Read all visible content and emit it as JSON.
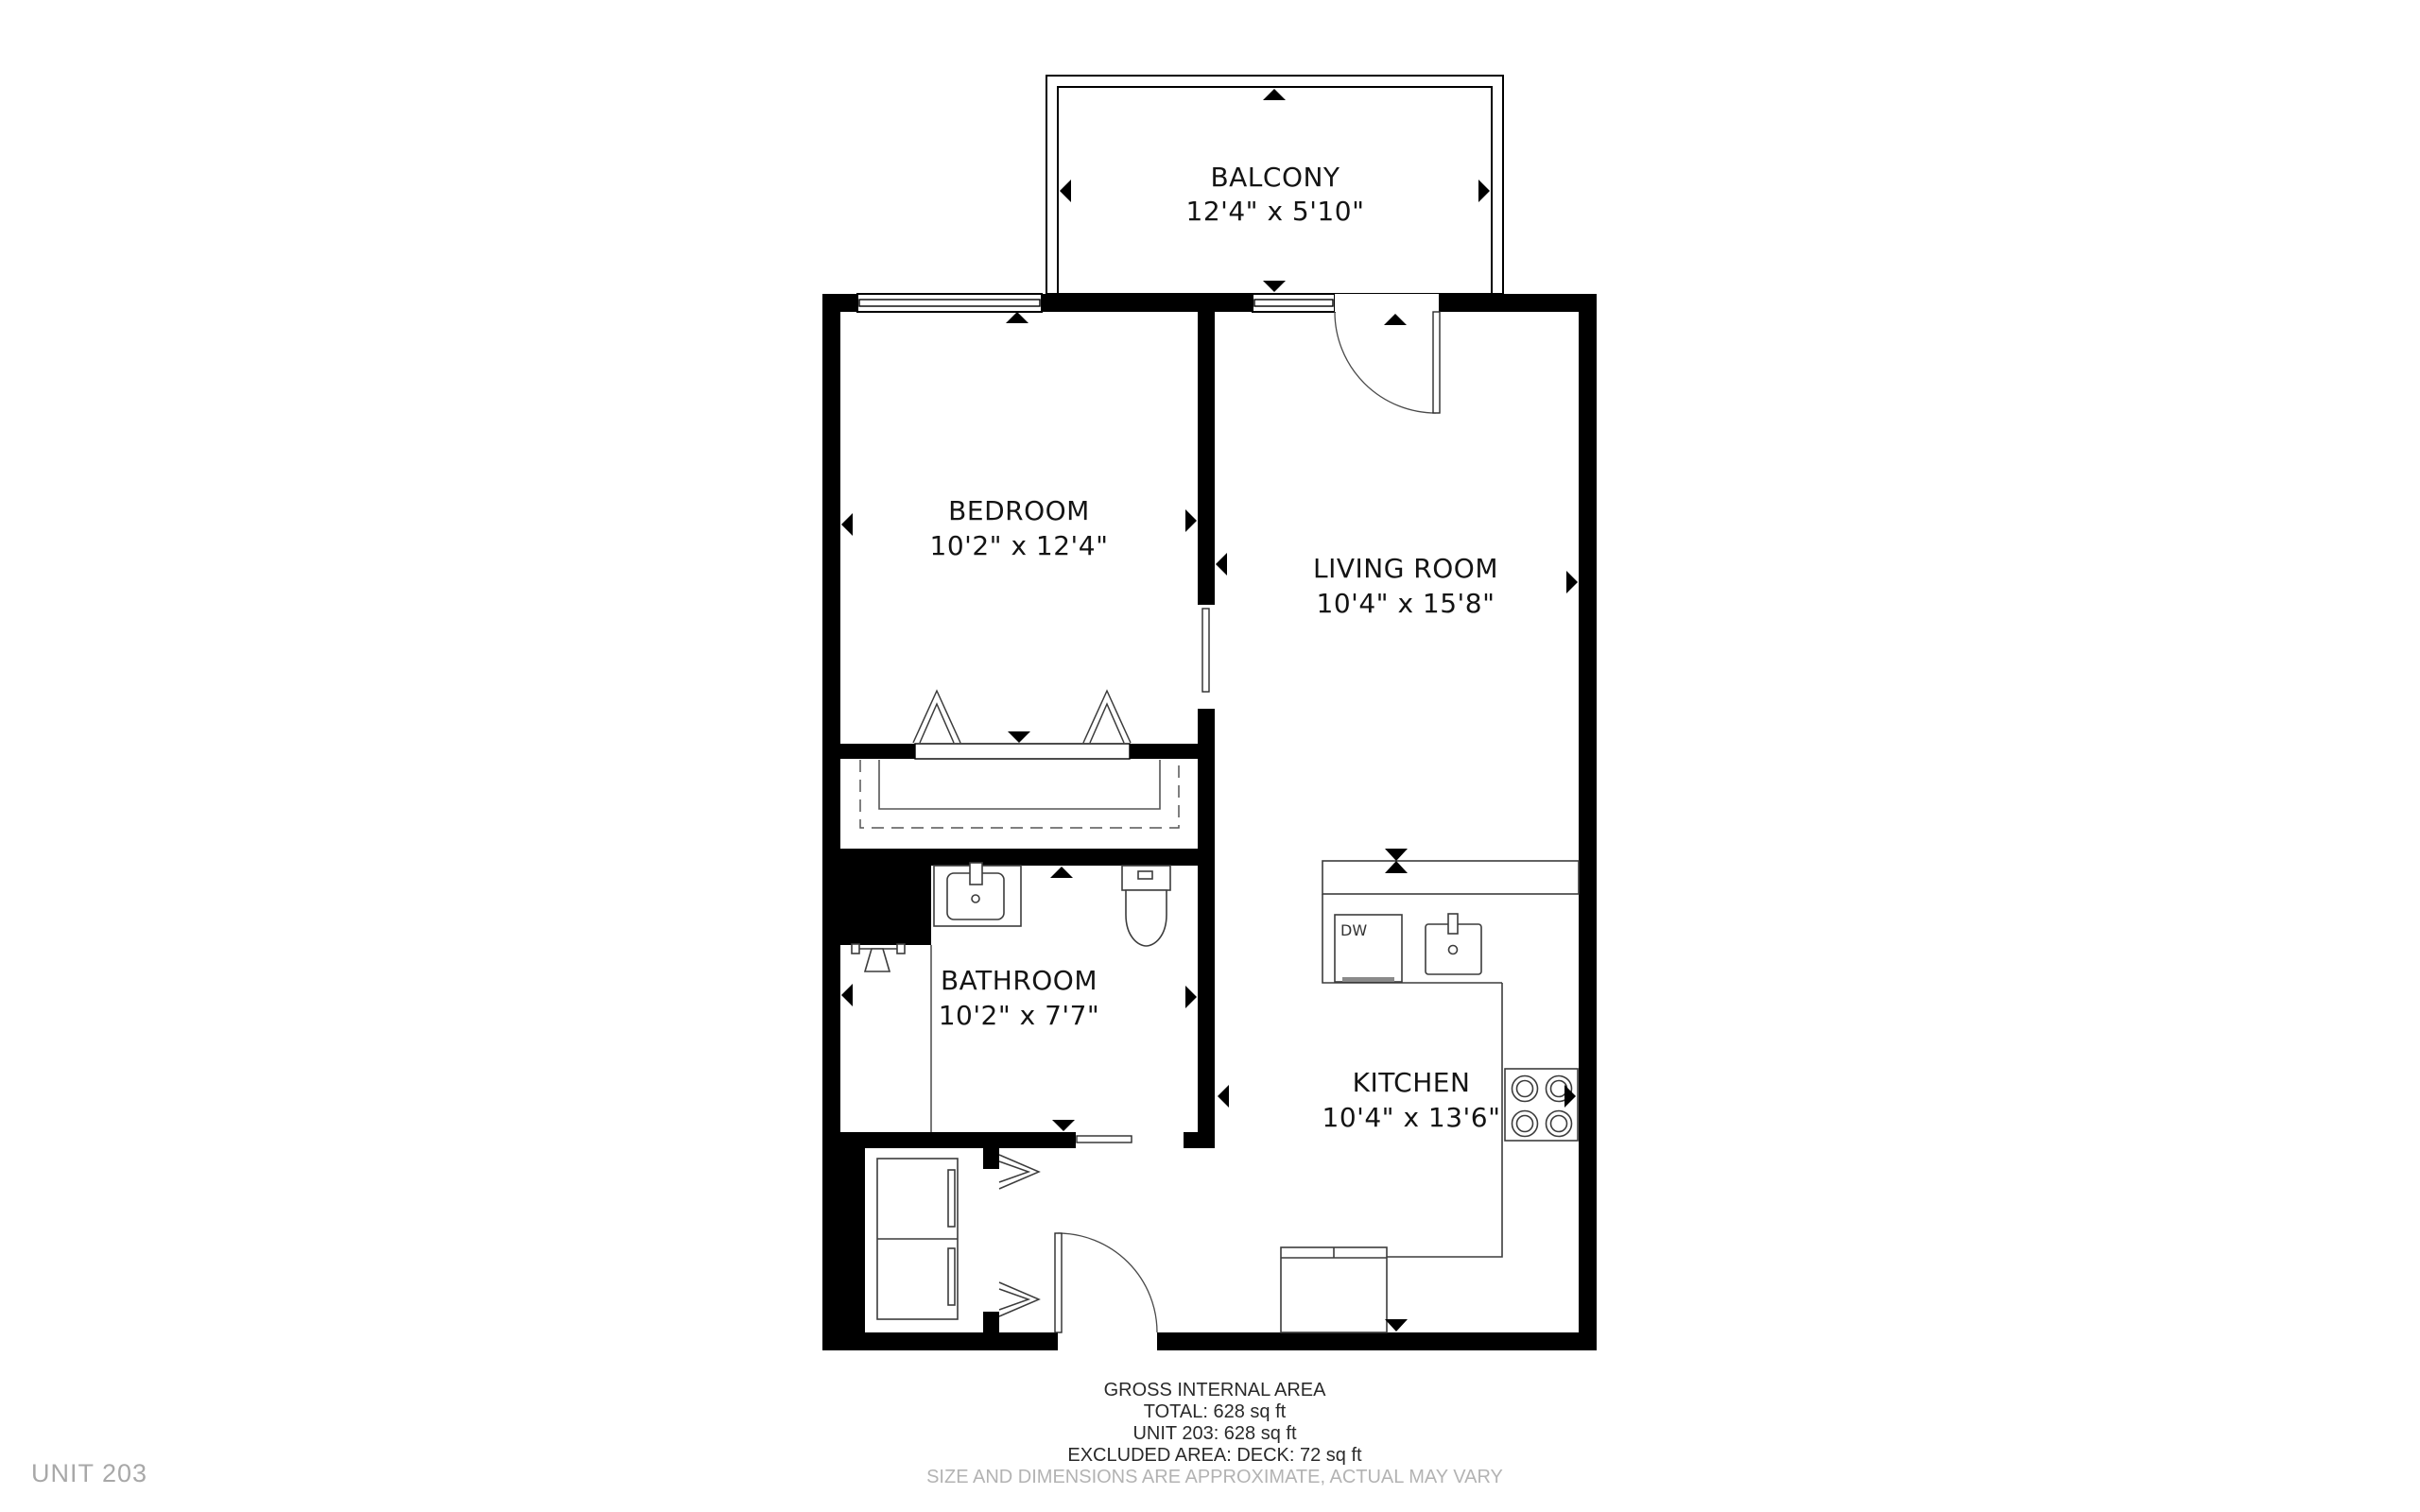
{
  "page": {
    "unit_watermark": "UNIT 203"
  },
  "rooms": {
    "balcony": {
      "name": "BALCONY",
      "dims": "12'4\" x 5'10\""
    },
    "bedroom": {
      "name": "BEDROOM",
      "dims": "10'2\" x 12'4\""
    },
    "living_room": {
      "name": "LIVING ROOM",
      "dims": "10'4\" x 15'8\""
    },
    "bathroom": {
      "name": "BATHROOM",
      "dims": "10'2\" x 7'7\""
    },
    "kitchen": {
      "name": "KITCHEN",
      "dims": "10'4\" x 13'6\""
    }
  },
  "fixtures": {
    "dishwasher_label": "DW"
  },
  "footer": {
    "heading": "GROSS INTERNAL AREA",
    "total": "TOTAL: 628 sq ft",
    "unit_area": "UNIT 203: 628 sq ft",
    "excluded": "EXCLUDED AREA: DECK: 72 sq ft",
    "disclaimer": "SIZE AND DIMENSIONS ARE APPROXIMATE, ACTUAL MAY VARY"
  },
  "colors": {
    "walls": "#000000",
    "text": "#141414",
    "muted": "#b3b3b3"
  }
}
